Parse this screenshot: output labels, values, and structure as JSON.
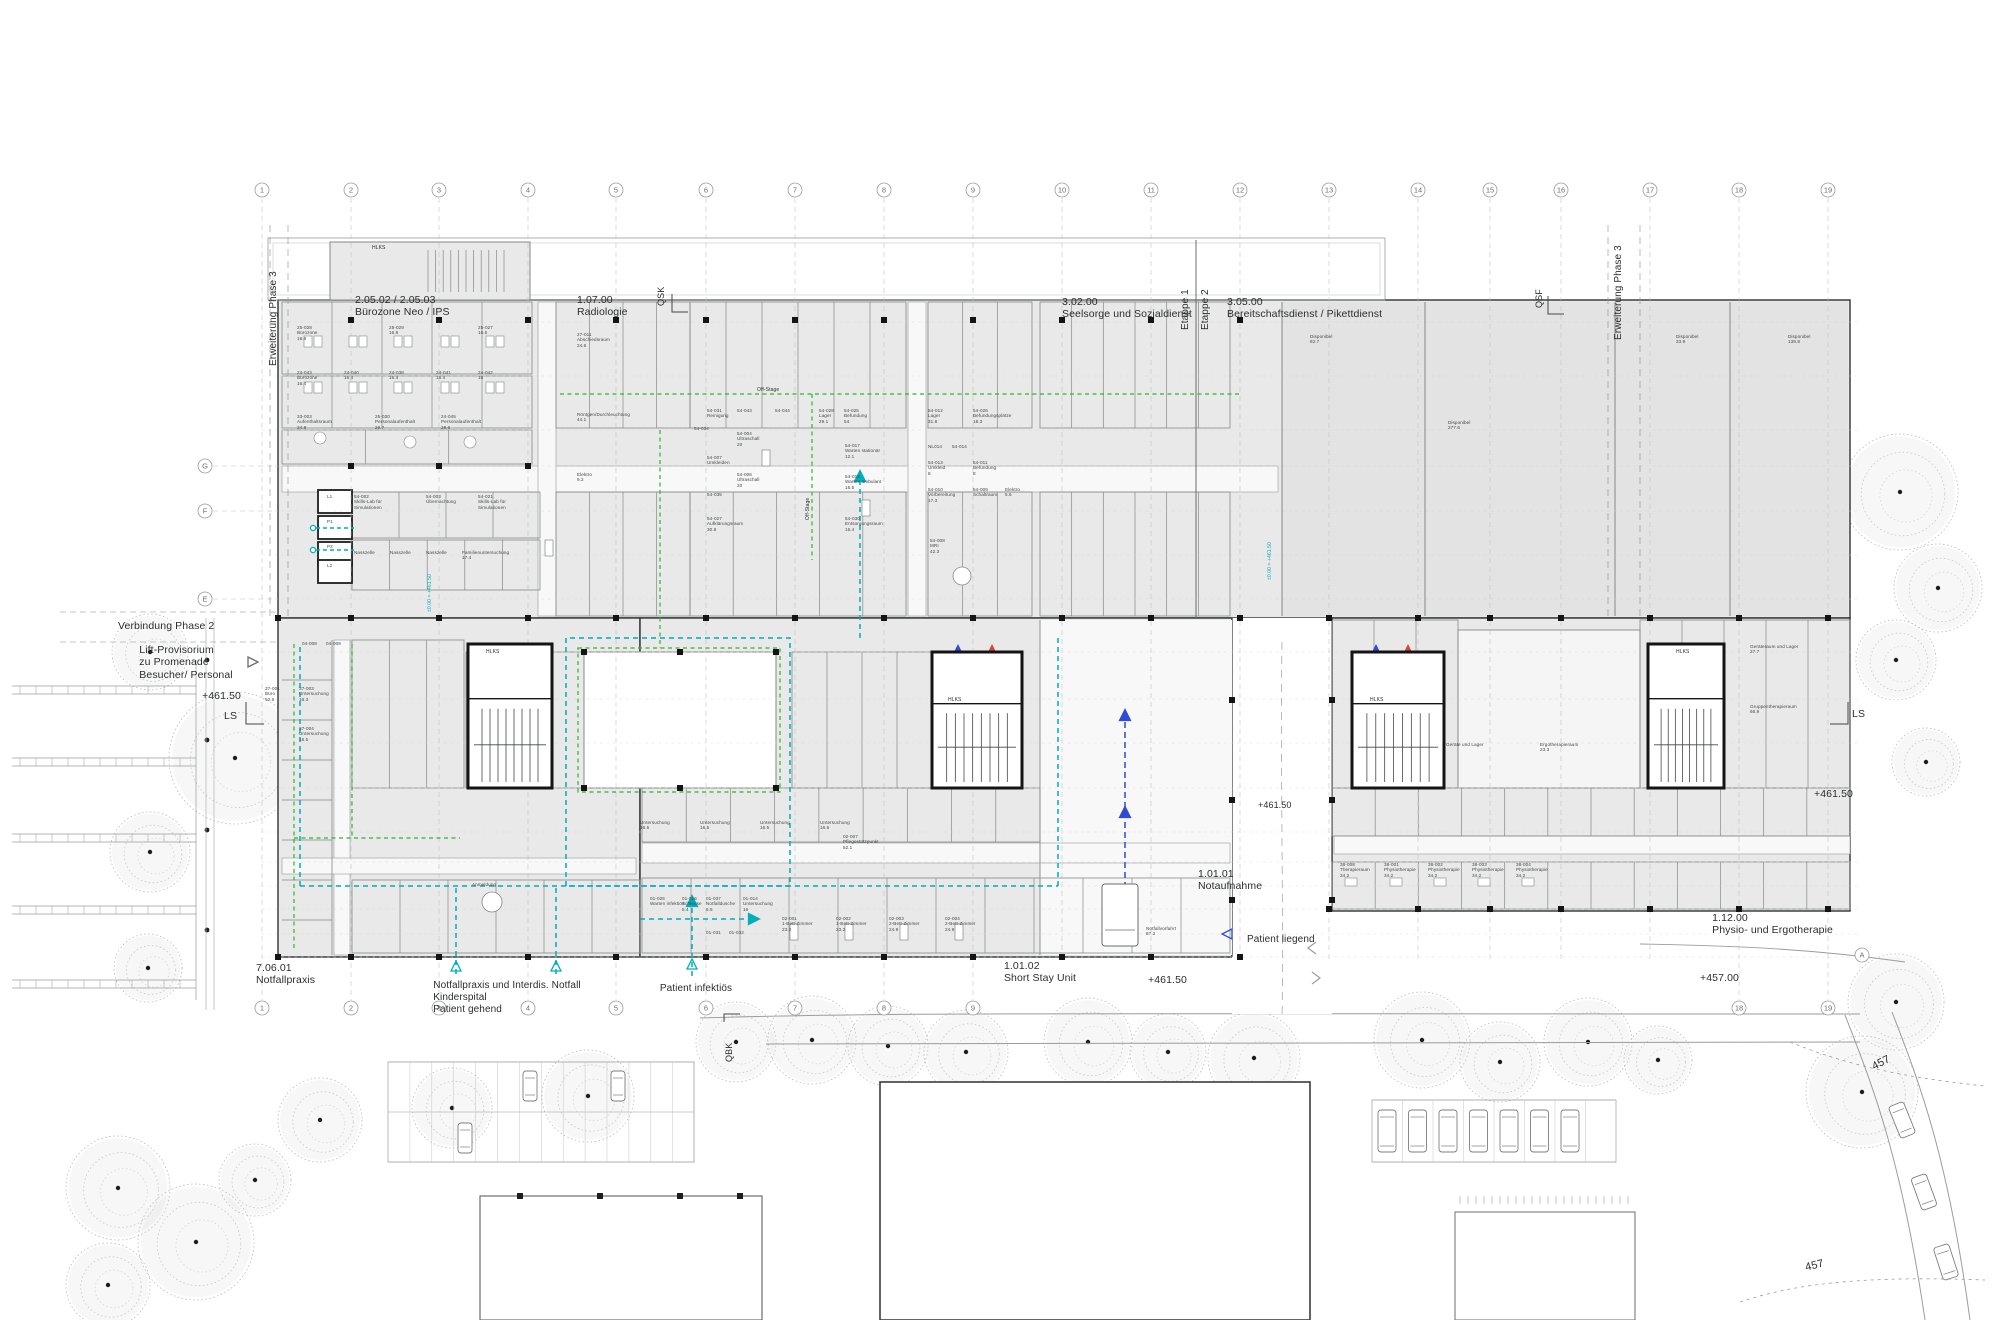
{
  "colors": {
    "teal": "#00aebc",
    "green": "#2db52d",
    "blue": "#2f4bd6",
    "red": "#d6482f",
    "building": "#e8e9e8",
    "building_alt": "#e2e3e2",
    "wall": "#868988",
    "dark": "#2f3231",
    "grid": "#bcbfbe",
    "text": "#2b2e2d",
    "tree": "#b6b9b7"
  },
  "grid": {
    "columns": [
      "1",
      "2",
      "3",
      "4",
      "5",
      "6",
      "7",
      "8",
      "9",
      "10",
      "11",
      "12",
      "13",
      "14",
      "15",
      "16",
      "17",
      "18",
      "19"
    ],
    "rows_left": [
      "G",
      "F",
      "E"
    ],
    "rows_right": [
      "A"
    ]
  },
  "labels": [
    {
      "n": "section-buerozone-neo-ips",
      "t": "2.05.02 / 2.05.03\nBürozone Neo / IPS",
      "x": 355,
      "y": 294,
      "s": 10.5
    },
    {
      "n": "section-radiologie",
      "t": "1.07.00\nRadiologie",
      "x": 577,
      "y": 294,
      "s": 10.5
    },
    {
      "n": "section-seelsorge",
      "t": "3.02.00\nSeelsorge und Sozialdienst",
      "x": 1062,
      "y": 296,
      "s": 10.5
    },
    {
      "n": "section-bereitschaftsdienst",
      "t": "3.05.00\nBereitschaftsdienst / Pikettdienst",
      "x": 1227,
      "y": 296,
      "s": 10.5
    },
    {
      "n": "section-notfallpraxis",
      "t": "7.06.01\nNotfallpraxis",
      "x": 256,
      "y": 962,
      "s": 10.5
    },
    {
      "n": "section-short-stay-unit",
      "t": "1.01.02\nShort Stay Unit",
      "x": 1040,
      "y": 960,
      "s": 10.5,
      "a": "center"
    },
    {
      "n": "section-notaufnahme",
      "t": "1.01.01\nNotaufnahme",
      "x": 1198,
      "y": 868,
      "s": 10.5
    },
    {
      "n": "section-physio-ergotherapie",
      "t": "1.12.00\nPhysio- und Ergotherapie",
      "x": 1833,
      "y": 912,
      "s": 10.5,
      "a": "right"
    },
    {
      "n": "flow-patient-gehend",
      "t": "Notfallpraxis und Interdis. Notfall\nKinderspital\nPatient gehend",
      "x": 507,
      "y": 980,
      "s": 10,
      "a": "center"
    },
    {
      "n": "flow-patient-infektioes",
      "t": "Patient infektiös",
      "x": 696,
      "y": 983,
      "s": 10,
      "a": "center"
    },
    {
      "n": "flow-patient-liegend",
      "t": "Patient liegend",
      "x": 1247,
      "y": 934,
      "s": 10
    },
    {
      "n": "verbindung-phase-2",
      "t": "Verbindung Phase 2",
      "x": 118,
      "y": 620,
      "s": 10.5
    },
    {
      "n": "lift-provisorium",
      "t": "Lift-Provisorium\nzu Promenade\nBesucher/ Personal",
      "x": 186,
      "y": 644,
      "s": 10.5,
      "a": "center"
    },
    {
      "n": "level-west",
      "t": "+461.50",
      "x": 202,
      "y": 690,
      "s": 10.5
    },
    {
      "n": "ls-west",
      "t": "LS",
      "x": 224,
      "y": 710,
      "s": 10.5
    },
    {
      "n": "level-south",
      "t": "+461.50",
      "x": 1148,
      "y": 974,
      "s": 10.5
    },
    {
      "n": "level-457",
      "t": "+457.00",
      "x": 1700,
      "y": 972,
      "s": 10.5
    },
    {
      "n": "level-east",
      "t": "+461.50",
      "x": 1814,
      "y": 788,
      "s": 10.5
    },
    {
      "n": "ls-east",
      "t": "LS",
      "x": 1852,
      "y": 708,
      "s": 10.5
    },
    {
      "n": "level-driveway",
      "t": "+461.50",
      "x": 1258,
      "y": 800,
      "s": 9
    },
    {
      "n": "contour-457-upper",
      "t": "457",
      "x": 1870,
      "y": 1062,
      "s": 11,
      "r": -28
    },
    {
      "n": "contour-457-lower",
      "t": "457",
      "x": 1804,
      "y": 1262,
      "s": 11,
      "r": -14
    },
    {
      "n": "erweiterung-phase3-west",
      "t": "Erweiterung Phase 3",
      "x": 268,
      "y": 366,
      "s": 10,
      "r": -90
    },
    {
      "n": "erweiterung-phase3-east",
      "t": "Erweiterung Phase 3",
      "x": 1613,
      "y": 340,
      "s": 10,
      "r": -90
    },
    {
      "n": "etappe-1",
      "t": "Etappe 1",
      "x": 1180,
      "y": 330,
      "s": 10,
      "r": -90
    },
    {
      "n": "etappe-2",
      "t": "Etappe 2",
      "x": 1200,
      "y": 330,
      "s": 10,
      "r": -90
    },
    {
      "n": "marker-qsk",
      "t": "QSK",
      "x": 656,
      "y": 306,
      "s": 9,
      "r": -90
    },
    {
      "n": "marker-qsf",
      "t": "QSF",
      "x": 1534,
      "y": 308,
      "s": 9,
      "r": -90
    },
    {
      "n": "marker-qbk",
      "t": "QBK",
      "x": 724,
      "y": 1062,
      "s": 9,
      "r": -90
    },
    {
      "n": "core-hlks-annex",
      "t": "HLKS",
      "x": 372,
      "y": 246,
      "s": 5
    },
    {
      "n": "core-hlks-1",
      "t": "HLKS",
      "x": 486,
      "y": 650,
      "s": 5
    },
    {
      "n": "core-hlks-2",
      "t": "HLKS",
      "x": 948,
      "y": 698,
      "s": 5
    },
    {
      "n": "core-hlks-3",
      "t": "HLKS",
      "x": 1370,
      "y": 698,
      "s": 5
    },
    {
      "n": "core-hlks-4",
      "t": "HLKS",
      "x": 1676,
      "y": 650,
      "s": 5
    },
    {
      "n": "route-offstage-1",
      "t": "Off-Stage",
      "x": 757,
      "y": 388,
      "s": 5
    },
    {
      "n": "route-offstage-2",
      "t": "Off-Stage",
      "x": 806,
      "y": 520,
      "s": 5,
      "r": -90
    },
    {
      "n": "elev-teal-west",
      "t": "±0.00 = +461.50",
      "x": 428,
      "y": 612,
      "s": 5,
      "r": -90,
      "c": "teal"
    },
    {
      "n": "elev-teal-east",
      "t": "±0.00 = +461.50",
      "x": 1268,
      "y": 580,
      "s": 5,
      "r": -90,
      "c": "teal"
    }
  ],
  "rooms": [
    {
      "c": "25-028",
      "n": "Bürozone",
      "a": "16.8",
      "x": 297,
      "y": 325
    },
    {
      "c": "25-029",
      "a": "16.8",
      "x": 389,
      "y": 325
    },
    {
      "c": "25-027",
      "a": "16.5",
      "x": 478,
      "y": 325
    },
    {
      "c": "24-043",
      "n": "Bürozone",
      "a": "16.4",
      "x": 297,
      "y": 370
    },
    {
      "c": "24-040",
      "a": "16.4",
      "x": 344,
      "y": 370
    },
    {
      "c": "24-038",
      "a": "16.4",
      "x": 389,
      "y": 370
    },
    {
      "c": "24-041",
      "a": "16.4",
      "x": 436,
      "y": 370
    },
    {
      "c": "24-042",
      "a": "16",
      "x": 478,
      "y": 370
    },
    {
      "c": "33-003",
      "n": "Aufenthaltsraum",
      "a": "24.8",
      "x": 297,
      "y": 414
    },
    {
      "c": "25-030",
      "n": "Personalaufenthalt",
      "a": "29.7",
      "x": 375,
      "y": 414
    },
    {
      "c": "24-045",
      "n": "Personalaufenthalt",
      "a": "28.6",
      "x": 441,
      "y": 414
    },
    {
      "c": "54-002",
      "n": "Skills-Lab für\nSimulationen",
      "x": 354,
      "y": 494
    },
    {
      "c": "54-003",
      "n": "Übernachtung",
      "x": 426,
      "y": 494
    },
    {
      "c": "54-021",
      "n": "Skills-Lab für\nSimulationen",
      "x": 478,
      "y": 494
    },
    {
      "n": "Nasszelle",
      "x": 354,
      "y": 550
    },
    {
      "n": "Nasszelle",
      "x": 390,
      "y": 550
    },
    {
      "n": "Nasszelle",
      "x": 426,
      "y": 550
    },
    {
      "n": "Familienuntersuchung",
      "a": "17.4",
      "x": 462,
      "y": 550
    },
    {
      "c": "L1",
      "x": 327,
      "y": 494
    },
    {
      "c": "P1",
      "x": 327,
      "y": 519
    },
    {
      "c": "P2",
      "x": 327,
      "y": 544
    },
    {
      "c": "L2",
      "x": 327,
      "y": 563
    },
    {
      "c": "04-008",
      "x": 302,
      "y": 641
    },
    {
      "c": "04-009",
      "x": 326,
      "y": 641
    },
    {
      "c": "37-001",
      "n": "Büro",
      "a": "92.9",
      "x": 265,
      "y": 686
    },
    {
      "c": "37-003",
      "n": "Untersuchung",
      "a": "16.3",
      "x": 299,
      "y": 686
    },
    {
      "c": "37-004",
      "n": "Untersuchung",
      "a": "16.5",
      "x": 299,
      "y": 726
    },
    {
      "c": "27-011",
      "n": "Abschiedsraum",
      "a": "24.6",
      "x": 577,
      "y": 332
    },
    {
      "n": "Röntgen/Durchleuchtung",
      "a": "44.1",
      "x": 577,
      "y": 412
    },
    {
      "n": "Elektro",
      "a": "9.2",
      "x": 577,
      "y": 472
    },
    {
      "c": "54-031",
      "n": "Reinigung",
      "x": 707,
      "y": 408
    },
    {
      "c": "54-043",
      "x": 737,
      "y": 408
    },
    {
      "c": "54-044",
      "x": 775,
      "y": 408
    },
    {
      "c": "54-034",
      "x": 694,
      "y": 426
    },
    {
      "c": "54-004",
      "n": "Ultraschall",
      "a": "20",
      "x": 737,
      "y": 431
    },
    {
      "c": "54-007",
      "n": "Umkleiden",
      "x": 707,
      "y": 455
    },
    {
      "c": "54-006",
      "n": "Ultraschall",
      "a": "20",
      "x": 737,
      "y": 472
    },
    {
      "c": "54-035",
      "x": 707,
      "y": 492
    },
    {
      "c": "54-027",
      "n": "Aufklärungsraum",
      "a": "30.8",
      "x": 707,
      "y": 516
    },
    {
      "c": "54-028",
      "n": "Lager",
      "a": "29.1",
      "x": 819,
      "y": 408
    },
    {
      "c": "54-025",
      "n": "Befundung",
      "a": "54",
      "x": 844,
      "y": 408
    },
    {
      "c": "54-017",
      "n": "Warten stationär",
      "a": "12.1",
      "x": 845,
      "y": 443
    },
    {
      "c": "54-018",
      "n": "Warten ambulant",
      "a": "16.5",
      "x": 845,
      "y": 474
    },
    {
      "c": "54-030",
      "n": "Entsorgungsraum",
      "a": "16.4",
      "x": 845,
      "y": 516
    },
    {
      "c": "54-012",
      "n": "Lager",
      "a": "31.8",
      "x": 928,
      "y": 408
    },
    {
      "c": "54-026",
      "n": "Befundungsplätze",
      "a": "18.3",
      "x": 973,
      "y": 408
    },
    {
      "c": "NL014",
      "x": 928,
      "y": 444
    },
    {
      "c": "54-014",
      "x": 952,
      "y": 444
    },
    {
      "c": "54-013",
      "n": "Umkleid",
      "a": "8",
      "x": 928,
      "y": 460
    },
    {
      "c": "54-011",
      "n": "Befundung",
      "a": "8",
      "x": 973,
      "y": 460
    },
    {
      "c": "54-010",
      "n": "Vorbereitung",
      "a": "17.3",
      "x": 928,
      "y": 487
    },
    {
      "c": "54-009",
      "n": "Schaltraum",
      "x": 973,
      "y": 487
    },
    {
      "n": "Elektro",
      "a": "5.6",
      "x": 1005,
      "y": 487
    },
    {
      "c": "54-008",
      "n": "MRI",
      "a": "42.3",
      "x": 930,
      "y": 538
    },
    {
      "n": "Untersuchung",
      "a": "16.5",
      "x": 640,
      "y": 820
    },
    {
      "n": "Untersuchung",
      "a": "16.5",
      "x": 700,
      "y": 820
    },
    {
      "n": "Untersuchung",
      "a": "16.5",
      "x": 760,
      "y": 820
    },
    {
      "n": "Untersuchung",
      "a": "16.6",
      "x": 820,
      "y": 820
    },
    {
      "c": "02-007",
      "n": "Pflegestützpunkt",
      "a": "52.1",
      "x": 843,
      "y": 834
    },
    {
      "c": "01-025",
      "n": "Warten infektiös",
      "x": 650,
      "y": 896
    },
    {
      "c": "01-016",
      "n": "Schleuse",
      "a": "5.4",
      "x": 682,
      "y": 896
    },
    {
      "c": "01-037",
      "n": "Notfalldusche",
      "a": "5.5",
      "x": 706,
      "y": 896
    },
    {
      "c": "01-014",
      "n": "Untersuchung",
      "a": "16",
      "x": 743,
      "y": 896
    },
    {
      "c": "01-031",
      "x": 706,
      "y": 930
    },
    {
      "c": "01-032",
      "x": 729,
      "y": 930
    },
    {
      "c": "02-001",
      "n": "1-Bett-Zimmer",
      "a": "23.2",
      "x": 782,
      "y": 916
    },
    {
      "c": "02-002",
      "n": "1-Bett-Zimmer",
      "a": "23.2",
      "x": 836,
      "y": 916
    },
    {
      "c": "02-003",
      "n": "2-Bett-Zimmer",
      "a": "24.9",
      "x": 889,
      "y": 916
    },
    {
      "c": "02-004",
      "n": "2-Bett-Zimmer",
      "a": "24.9",
      "x": 945,
      "y": 916
    },
    {
      "n": "Anmeldung",
      "x": 472,
      "y": 882
    },
    {
      "n": "Notfallvorfahrt",
      "a": "87.2",
      "x": 1146,
      "y": 926
    },
    {
      "c": "38-008",
      "n": "Therapieraum",
      "a": "34.2",
      "x": 1340,
      "y": 862
    },
    {
      "c": "38-001",
      "n": "Physiotherapie",
      "a": "34.2",
      "x": 1384,
      "y": 862
    },
    {
      "c": "38-002",
      "n": "Physiotherapie",
      "a": "34.2",
      "x": 1428,
      "y": 862
    },
    {
      "c": "38-003",
      "n": "Physiotherapie",
      "a": "34.2",
      "x": 1472,
      "y": 862
    },
    {
      "c": "38-004",
      "n": "Physiotherapie",
      "a": "34.2",
      "x": 1516,
      "y": 862
    },
    {
      "n": "Geräteraum und Lager",
      "a": "27.7",
      "x": 1750,
      "y": 644
    },
    {
      "n": "Gruppentherapieraum",
      "a": "66.9",
      "x": 1750,
      "y": 704
    },
    {
      "n": "Ergotherapieraum",
      "a": "23.3",
      "x": 1540,
      "y": 742
    },
    {
      "n": "Geräte und Lager",
      "x": 1446,
      "y": 742
    },
    {
      "n": "Disponibel",
      "a": "82.7",
      "x": 1310,
      "y": 334
    },
    {
      "n": "Disponibel",
      "a": "277.6",
      "x": 1448,
      "y": 420
    },
    {
      "n": "Disponibel",
      "a": "33.9",
      "x": 1676,
      "y": 334
    },
    {
      "n": "Disponibel",
      "a": "139.8",
      "x": 1788,
      "y": 334
    }
  ]
}
